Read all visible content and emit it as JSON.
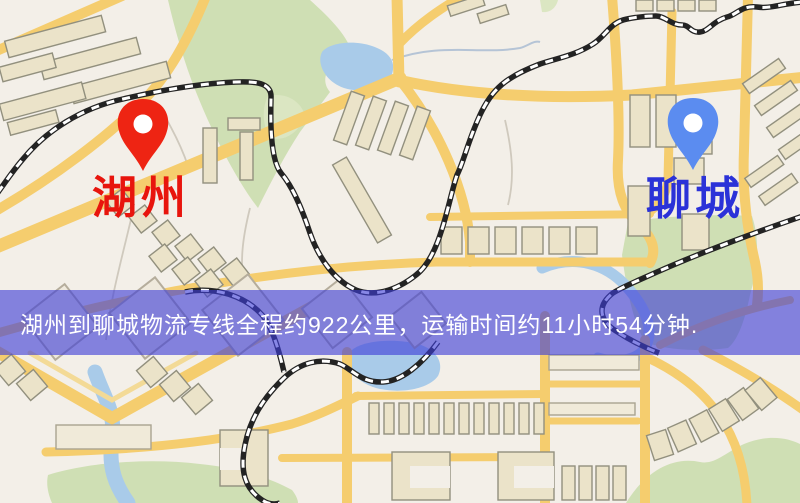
{
  "map": {
    "origin": {
      "name": "湖州"
    },
    "destination": {
      "name": "聊城"
    },
    "banner": {
      "text": "湖州到聊城物流专线全程约922公里，运输时间约11小时54分钟.",
      "distance": "922公里",
      "duration": "11小时54分钟"
    },
    "colors": {
      "origin-pin": "#ee2413",
      "origin-label": "#e8150d",
      "destination-pin": "#5b8cf0",
      "destination-label": "#2b32d8",
      "banner-overlay": "rgba(62,62,215,0.62)",
      "banner-text": "#ffffff",
      "road-yellow": "#f5cd6e",
      "road-light": "#f3da96",
      "water-blue": "#a9cbe9",
      "park-green": "#cfdfb4",
      "building-tan": "#ebe3c9",
      "building-outline": "#92907e",
      "railway-black": "#232323",
      "map-bg": "#f3efe8"
    }
  }
}
